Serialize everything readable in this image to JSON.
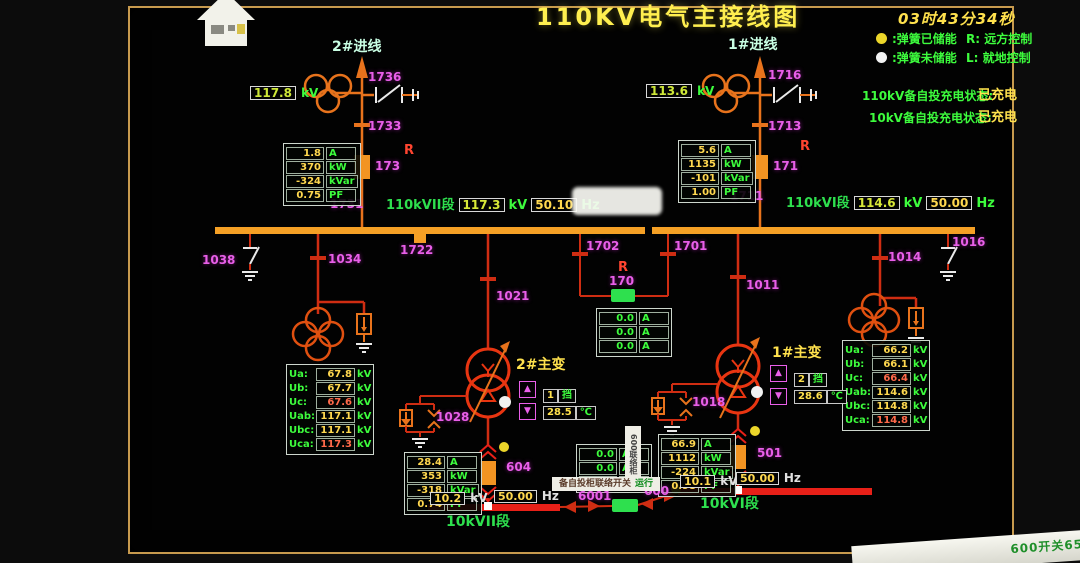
{
  "header": {
    "title": "110KV电气主接线图",
    "clock": "03时43分34秒",
    "legend": {
      "charged": ":弹簧已储能",
      "remote": "R: 远方控制",
      "uncharged": ":弹簧未储能",
      "local": "L: 就地控制"
    },
    "status": [
      {
        "label": "110kV备自投充电状态:",
        "value": "已充电"
      },
      {
        "label": "10kV备自投充电状态:",
        "value": "已充电"
      }
    ]
  },
  "incomer2": {
    "name": "2#进线",
    "kv": "117.8",
    "kv_unit": "kV",
    "disc_top": "1736",
    "disc_mid": "1733",
    "flag": "R",
    "breaker": "173",
    "bus_tag": "1731",
    "meas": [
      {
        "v": "1.8",
        "u": "A"
      },
      {
        "v": "370",
        "u": "kW"
      },
      {
        "v": "-324",
        "u": "kVar"
      },
      {
        "v": "0.75",
        "u": "PF"
      }
    ]
  },
  "incomer1": {
    "name": "1#进线",
    "kv": "113.6",
    "kv_unit": "kV",
    "disc_top": "1716",
    "disc_mid": "1713",
    "flag": "R",
    "breaker": "171",
    "bus_tag": "1711",
    "meas": [
      {
        "v": "5.6",
        "u": "A"
      },
      {
        "v": "1135",
        "u": "kW"
      },
      {
        "v": "-101",
        "u": "kVar"
      },
      {
        "v": "1.00",
        "u": "PF"
      }
    ]
  },
  "bus110_2": {
    "name": "110kVII段",
    "kv": "117.3",
    "kv_unit": "kV",
    "hz": "50.10",
    "hz_unit": "Hz",
    "joint": "1722",
    "earth": "1038"
  },
  "bus110_1": {
    "name": "110kVI段",
    "kv": "114.6",
    "kv_unit": "kV",
    "hz": "50.00",
    "hz_unit": "Hz",
    "earth": "1016"
  },
  "tie110": {
    "flag": "R",
    "breaker": "170",
    "disc_left": "1702",
    "disc_right": "1701",
    "meas": [
      {
        "v": "0.0",
        "u": "A"
      },
      {
        "v": "0.0",
        "u": "A"
      },
      {
        "v": "0.0",
        "u": "A"
      }
    ]
  },
  "pt2": {
    "disc": "1034",
    "rows": [
      {
        "l": "Ua:",
        "v": "67.8",
        "u": "kV"
      },
      {
        "l": "Ub:",
        "v": "67.7",
        "u": "kV"
      },
      {
        "l": "Uc:",
        "v": "67.6",
        "u": "kV"
      },
      {
        "l": "Uab:",
        "v": "117.1",
        "u": "kV"
      },
      {
        "l": "Ubc:",
        "v": "117.1",
        "u": "kV"
      },
      {
        "l": "Uca:",
        "v": "117.3",
        "u": "kV"
      }
    ]
  },
  "pt1": {
    "disc": "1014",
    "rows": [
      {
        "l": "Ua:",
        "v": "66.2",
        "u": "kV"
      },
      {
        "l": "Ub:",
        "v": "66.1",
        "u": "kV"
      },
      {
        "l": "Uc:",
        "v": "66.4",
        "u": "kV"
      },
      {
        "l": "Uab:",
        "v": "114.6",
        "u": "kV"
      },
      {
        "l": "Ubc:",
        "v": "114.8",
        "u": "kV"
      },
      {
        "l": "Uca:",
        "v": "114.8",
        "u": "kV"
      }
    ]
  },
  "tx2": {
    "name": "2#主变",
    "disc": "1021",
    "arrester": "1028",
    "tap_up": "▲",
    "tap_down": "▼",
    "tap": "1",
    "tap_unit": "挡",
    "temp": "28.5",
    "temp_unit": "℃",
    "breaker": "604",
    "meas": [
      {
        "v": "28.4",
        "u": "A"
      },
      {
        "v": "353",
        "u": "kW"
      },
      {
        "v": "-318",
        "u": "kVar"
      },
      {
        "v": "0.74",
        "u": "PF"
      }
    ]
  },
  "tx1": {
    "name": "1#主变",
    "disc": "1011",
    "arrester": "1018",
    "tap_up": "▲",
    "tap_down": "▼",
    "tap": "2",
    "tap_unit": "挡",
    "temp": "28.6",
    "temp_unit": "℃",
    "breaker": "501",
    "meas": [
      {
        "v": "66.9",
        "u": "A"
      },
      {
        "v": "1112",
        "u": "kW"
      },
      {
        "v": "-224",
        "u": "kVar"
      },
      {
        "v": "0.98",
        "u": "PF"
      }
    ]
  },
  "bus10_2": {
    "name": "10kVII段",
    "kv": "10.2",
    "kv_unit": "kV",
    "hz": "50.00",
    "hz_unit": "Hz"
  },
  "bus10_1": {
    "name": "10kVI段",
    "kv": "10.1",
    "kv_unit": "kV",
    "hz": "50.00",
    "hz_unit": "Hz"
  },
  "tie10": {
    "disc": "6001",
    "breaker": "600",
    "cabinet": "600联络柜",
    "info": "备自投柜联络开关",
    "info_status": "运行",
    "meas": [
      {
        "v": "0.0",
        "u": "A"
      },
      {
        "v": "0.0",
        "u": "A"
      },
      {
        "v": "0.0",
        "u": "A"
      }
    ]
  },
  "statusbar": {
    "text": "600开关6510"
  }
}
